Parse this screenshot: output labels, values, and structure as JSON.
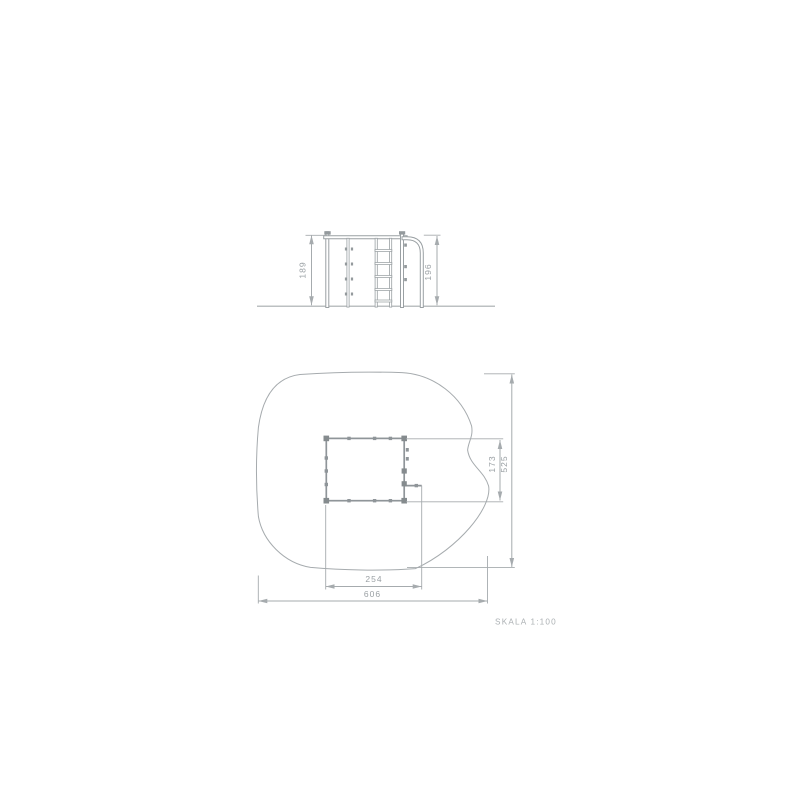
{
  "drawing": {
    "scale_label": "SKALA 1:100",
    "elevation": {
      "dim_frame_height": "189",
      "dim_pole_height": "196"
    },
    "plan": {
      "dim_equipment_width": "254",
      "dim_safety_zone_width": "606",
      "dim_equipment_depth": "173",
      "dim_safety_zone_depth": "525"
    },
    "colors": {
      "dimension": "#a6abae",
      "structure": "#9aa0a3",
      "footprint": "#8f9599",
      "marker": "#858b8e",
      "text": "#9aa0a4"
    }
  }
}
